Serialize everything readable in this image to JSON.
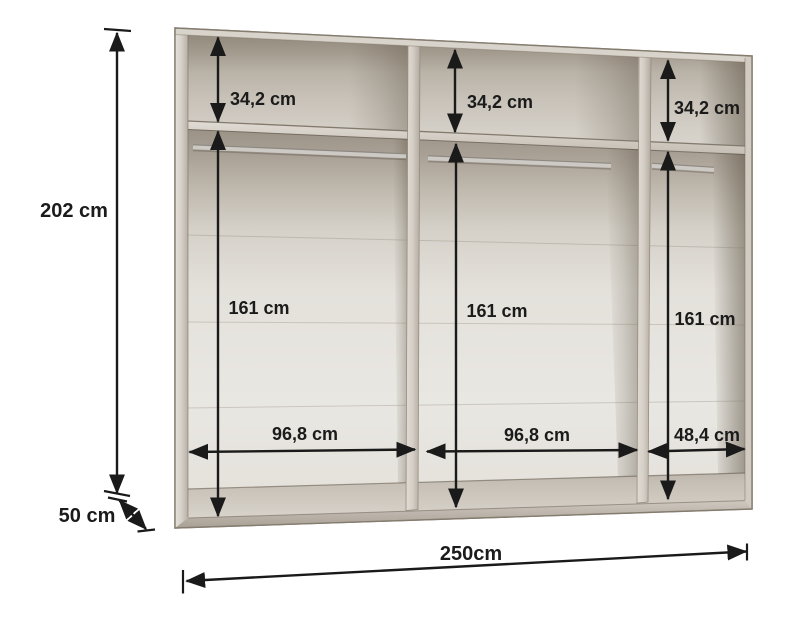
{
  "diagram": {
    "type": "furniture-dimension-diagram",
    "subject": "wardrobe interior with three sections, top shelves and hanging rails",
    "units": "cm"
  },
  "dimensions": {
    "overall_height": "202 cm",
    "overall_depth": "50 cm",
    "overall_width": "250cm",
    "sections": [
      {
        "position": "left",
        "top_shelf_height": "34,2 cm",
        "hanging_space_height": "161 cm",
        "inner_width": "96,8 cm"
      },
      {
        "position": "middle",
        "top_shelf_height": "34,2 cm",
        "hanging_space_height": "161 cm",
        "inner_width": "96,8 cm"
      },
      {
        "position": "right",
        "top_shelf_height": "34,2 cm",
        "hanging_space_height": "161 cm",
        "inner_width": "48,4 cm"
      }
    ]
  },
  "colors": {
    "background": "#ffffff",
    "dimension_lines": "#1a1a1a",
    "label_text": "#1b1b1b",
    "cabinet_frame": "#cdc6bd",
    "cabinet_interior_back": "#e7e4de",
    "cabinet_shadow": "#a79e92"
  }
}
